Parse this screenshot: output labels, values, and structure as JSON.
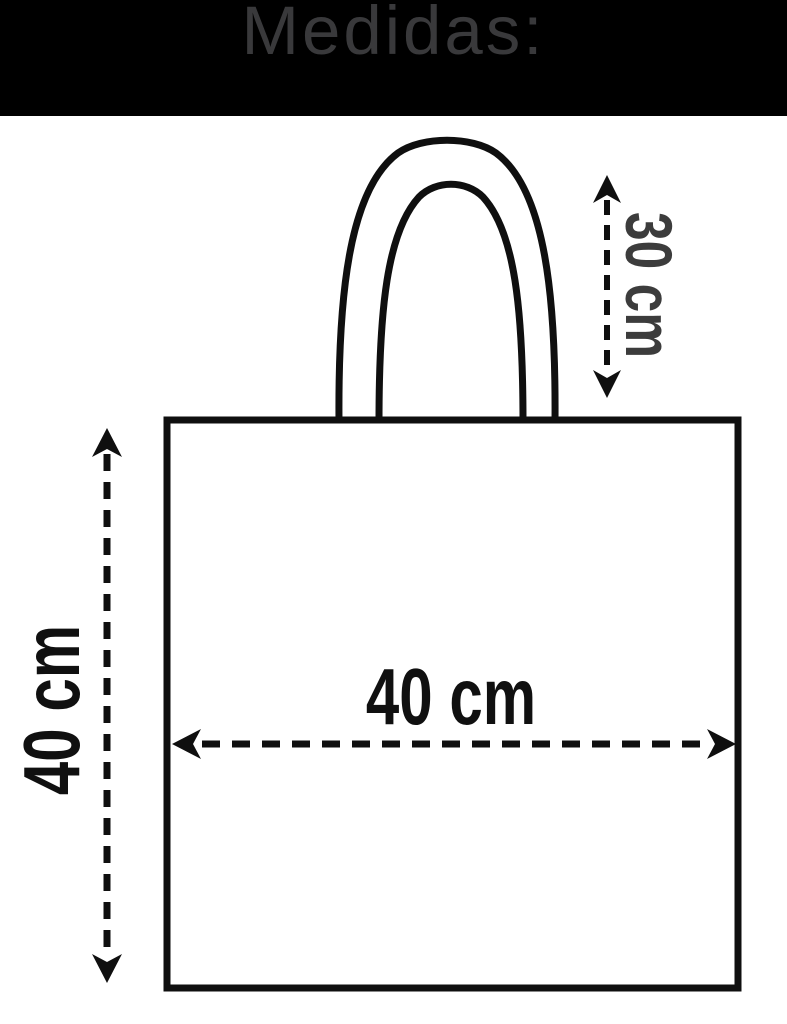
{
  "header": {
    "title": "Medidas:"
  },
  "measurements": {
    "handle_height": "30 cm",
    "bag_height": "40 cm",
    "bag_width": "40 cm"
  },
  "colors": {
    "header_background": "#000000",
    "header_text": "#39393b",
    "outline": "#0f0f0f",
    "measurement_text": "#101010",
    "handle_measurement_text": "#3c3c3c",
    "background": "#ffffff"
  }
}
